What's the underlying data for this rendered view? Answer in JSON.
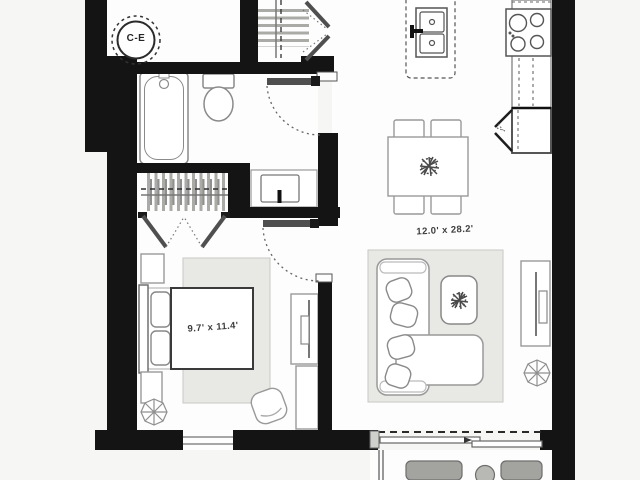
{
  "plan": {
    "labels": {
      "utility_circle": "C-E",
      "living_room_dimensions": "12.0' x 28.2'",
      "bedroom_dimensions": "9.7' x 11.4'"
    },
    "colors": {
      "background": "#f6f6f4",
      "room_floor": "#fdfdfd",
      "wall": "#141414",
      "furniture_outline": "#8f8f8f",
      "rug_fill": "#e8e8e5",
      "door_leaf": "#4f4f4f",
      "label_text": "#3d3d3d"
    },
    "fixtures": [
      "water-heater-circle",
      "bathtub",
      "toilet",
      "vanity-sink",
      "bathroom-door",
      "linen-closet-rod",
      "closet-french-doors",
      "entry-closet-bifold-doors",
      "kitchen-island-double-sink",
      "stove-cooktop",
      "kitchen-counter",
      "fridge-corner-unit",
      "dining-table",
      "dining-chairs",
      "plant-centerpiece",
      "sectional-sofa",
      "sofa-pillows",
      "coffee-table",
      "media-console",
      "potted-plant",
      "bed",
      "headboard",
      "pillows",
      "nightstands",
      "bedroom-rug",
      "living-rug",
      "desk-with-tv",
      "dresser",
      "armchair",
      "bedroom-door",
      "window",
      "sliding-balcony-door",
      "balcony-railing",
      "balcony-chairs",
      "balcony-table"
    ]
  }
}
